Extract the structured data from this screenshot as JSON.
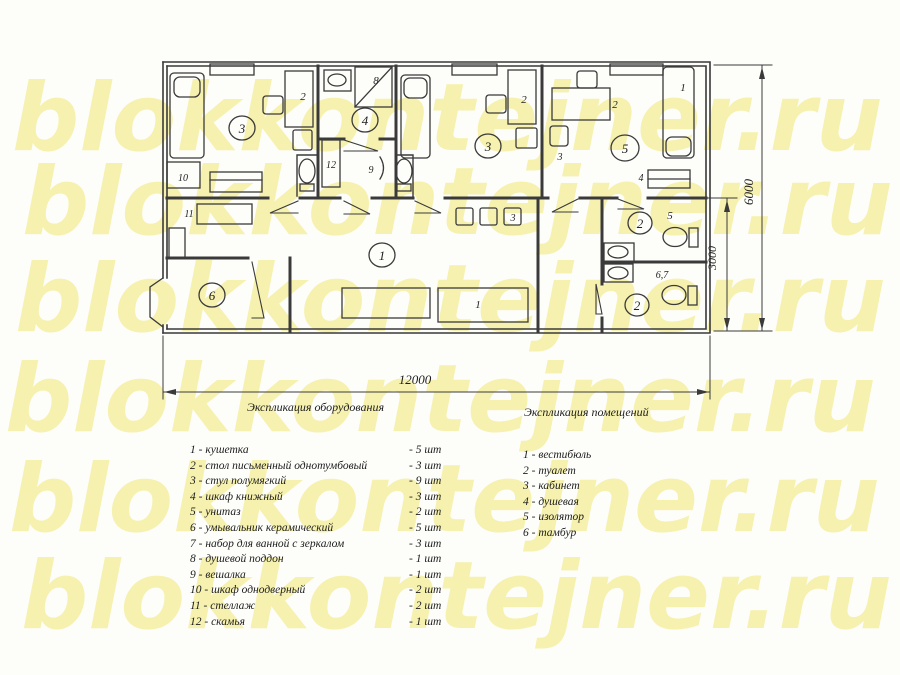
{
  "watermark": {
    "text": "blokkontejner.ru",
    "rows": 6,
    "color": "#f6f1ae"
  },
  "colors": {
    "line": "#3a3a3a",
    "text": "#1f1f1f",
    "background": "#fdfdfa"
  },
  "plan": {
    "room_labels": [
      "3",
      "4",
      "3",
      "5",
      "1",
      "2",
      "2",
      "6"
    ],
    "furniture_labels": {
      "table_a": "2",
      "cabinet_a": "10",
      "shower_tray": "8",
      "bench": "12",
      "hook": "9",
      "table_b": "2",
      "table_c": "2",
      "chair_c": "3",
      "bed_c": "1",
      "bookcase": "4",
      "shelf_unit": "11",
      "couch": "1",
      "stools": "3",
      "wc_top": "5",
      "wc_bottom": "6,7"
    },
    "dimensions": {
      "width": "12000",
      "height_total": "6000",
      "height_lower": "3000"
    }
  },
  "legend_equipment": {
    "title": "Экспликация оборудования",
    "items": [
      [
        "1 - кушетка",
        "- 5 шт"
      ],
      [
        "2 - стол письменный однотумбовый",
        "- 3 шт"
      ],
      [
        "3 - стул полумягкий",
        "- 9 шт"
      ],
      [
        "4 - шкаф книжный",
        "- 3 шт"
      ],
      [
        "5 - унитаз",
        "- 2 шт"
      ],
      [
        "6 - умывальник керамический",
        "- 5 шт"
      ],
      [
        "7 - набор для ванной с зеркалом",
        "- 3 шт"
      ],
      [
        "8 - душевой поддон",
        "- 1 шт"
      ],
      [
        "9 - вешалка",
        "- 1 шт"
      ],
      [
        "10 - шкаф однодверный",
        "- 2 шт"
      ],
      [
        "11 - стеллаж",
        "- 2 шт"
      ],
      [
        "12 - скамья",
        "- 1 шт"
      ]
    ]
  },
  "legend_rooms": {
    "title": "Экспликация помещений",
    "items": [
      "1 - вестибюль",
      "2 - туалет",
      "3 - кабинет",
      "4 - душевая",
      "5 - изолятор",
      "6 - тамбур"
    ]
  }
}
